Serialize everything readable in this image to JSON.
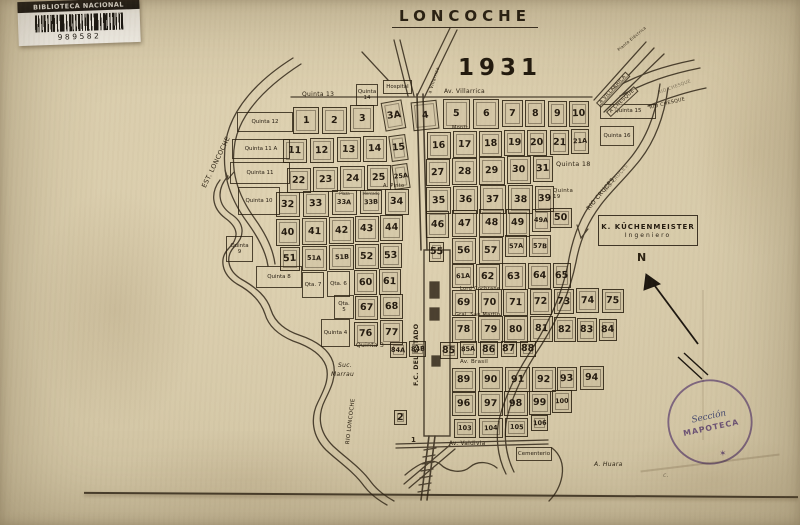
{
  "title": "LONCOCHE",
  "year": "1931",
  "barcode": {
    "library": "BIBLIOTECA NACIONAL",
    "number": "989582"
  },
  "credit": {
    "name": "K. KÜCHENMEISTER",
    "role": "Ingeniero"
  },
  "stamp": {
    "ring": "BIBLIOTECA NACIONAL",
    "star": "✶",
    "script": "Sección",
    "unit": "MAPOTECA"
  },
  "map": {
    "ink": "#2a2114",
    "blocks": [
      {
        "t": "1",
        "x": 293,
        "y": 107,
        "w": 26,
        "h": 27
      },
      {
        "t": "2",
        "x": 322,
        "y": 107,
        "w": 25,
        "h": 27
      },
      {
        "t": "3",
        "x": 350,
        "y": 105,
        "w": 24,
        "h": 27
      },
      {
        "t": "3A",
        "x": 383,
        "y": 101,
        "w": 21,
        "h": 29,
        "r": -10
      },
      {
        "t": "4",
        "x": 412,
        "y": 101,
        "w": 26,
        "h": 29,
        "r": -6
      },
      {
        "t": "5",
        "x": 443,
        "y": 99,
        "w": 27,
        "h": 30
      },
      {
        "t": "6",
        "x": 473,
        "y": 99,
        "w": 26,
        "h": 30
      },
      {
        "t": "7",
        "x": 502,
        "y": 100,
        "w": 21,
        "h": 27
      },
      {
        "t": "8",
        "x": 525,
        "y": 100,
        "w": 20,
        "h": 27
      },
      {
        "t": "9",
        "x": 548,
        "y": 101,
        "w": 19,
        "h": 26
      },
      {
        "t": "10",
        "x": 569,
        "y": 101,
        "w": 20,
        "h": 26
      },
      {
        "t": "11",
        "x": 283,
        "y": 139,
        "w": 24,
        "h": 24
      },
      {
        "t": "12",
        "x": 310,
        "y": 138,
        "w": 24,
        "h": 25
      },
      {
        "t": "13",
        "x": 337,
        "y": 137,
        "w": 24,
        "h": 25
      },
      {
        "t": "14",
        "x": 363,
        "y": 136,
        "w": 24,
        "h": 26
      },
      {
        "t": "15",
        "x": 390,
        "y": 135,
        "w": 17,
        "h": 26,
        "r": -8
      },
      {
        "t": "16",
        "x": 427,
        "y": 132,
        "w": 24,
        "h": 27
      },
      {
        "t": "17",
        "x": 453,
        "y": 131,
        "w": 24,
        "h": 27
      },
      {
        "t": "18",
        "x": 479,
        "y": 131,
        "w": 23,
        "h": 26
      },
      {
        "t": "19",
        "x": 504,
        "y": 130,
        "w": 21,
        "h": 26
      },
      {
        "t": "20",
        "x": 527,
        "y": 130,
        "w": 20,
        "h": 26
      },
      {
        "t": "21",
        "x": 550,
        "y": 130,
        "w": 19,
        "h": 25
      },
      {
        "t": "21A",
        "x": 571,
        "y": 129,
        "w": 18,
        "h": 25
      },
      {
        "t": "22",
        "x": 287,
        "y": 168,
        "w": 24,
        "h": 25
      },
      {
        "t": "23",
        "x": 313,
        "y": 167,
        "w": 25,
        "h": 25
      },
      {
        "t": "24",
        "x": 340,
        "y": 166,
        "w": 25,
        "h": 25
      },
      {
        "t": "25",
        "x": 367,
        "y": 165,
        "w": 24,
        "h": 25
      },
      {
        "t": "25A",
        "x": 393,
        "y": 164,
        "w": 16,
        "h": 25,
        "r": -8
      },
      {
        "t": "27",
        "x": 426,
        "y": 159,
        "w": 24,
        "h": 27
      },
      {
        "t": "28",
        "x": 452,
        "y": 158,
        "w": 25,
        "h": 27
      },
      {
        "t": "29",
        "x": 479,
        "y": 157,
        "w": 26,
        "h": 28
      },
      {
        "t": "30",
        "x": 507,
        "y": 156,
        "w": 24,
        "h": 28
      },
      {
        "t": "31",
        "x": 533,
        "y": 156,
        "w": 20,
        "h": 26
      },
      {
        "t": "32",
        "x": 276,
        "y": 192,
        "w": 24,
        "h": 25
      },
      {
        "t": "33",
        "x": 303,
        "y": 191,
        "w": 26,
        "h": 26
      },
      {
        "t": "33A",
        "x": 332,
        "y": 190,
        "w": 25,
        "h": 25,
        "c": "Plaza"
      },
      {
        "t": "33B",
        "x": 360,
        "y": 190,
        "w": 22,
        "h": 24,
        "c": "Mercado"
      },
      {
        "t": "34",
        "x": 385,
        "y": 189,
        "w": 24,
        "h": 26
      },
      {
        "t": "35",
        "x": 426,
        "y": 187,
        "w": 25,
        "h": 27
      },
      {
        "t": "36",
        "x": 453,
        "y": 186,
        "w": 25,
        "h": 28
      },
      {
        "t": "37",
        "x": 480,
        "y": 185,
        "w": 26,
        "h": 29
      },
      {
        "t": "38",
        "x": 508,
        "y": 185,
        "w": 25,
        "h": 29
      },
      {
        "t": "39",
        "x": 535,
        "y": 186,
        "w": 19,
        "h": 26
      },
      {
        "t": "50",
        "x": 550,
        "y": 208,
        "w": 22,
        "h": 20
      },
      {
        "t": "40",
        "x": 276,
        "y": 219,
        "w": 24,
        "h": 27
      },
      {
        "t": "41",
        "x": 302,
        "y": 218,
        "w": 25,
        "h": 27
      },
      {
        "t": "42",
        "x": 329,
        "y": 217,
        "w": 25,
        "h": 27
      },
      {
        "t": "43",
        "x": 355,
        "y": 216,
        "w": 24,
        "h": 26
      },
      {
        "t": "44",
        "x": 380,
        "y": 215,
        "w": 23,
        "h": 26
      },
      {
        "t": "46",
        "x": 426,
        "y": 211,
        "w": 23,
        "h": 27
      },
      {
        "t": "47",
        "x": 452,
        "y": 210,
        "w": 25,
        "h": 27
      },
      {
        "t": "48",
        "x": 479,
        "y": 209,
        "w": 25,
        "h": 28
      },
      {
        "t": "49",
        "x": 506,
        "y": 209,
        "w": 24,
        "h": 28
      },
      {
        "t": "49A",
        "x": 532,
        "y": 209,
        "w": 19,
        "h": 23
      },
      {
        "t": "51",
        "x": 280,
        "y": 247,
        "w": 20,
        "h": 24
      },
      {
        "t": "51A",
        "x": 302,
        "y": 246,
        "w": 25,
        "h": 25
      },
      {
        "t": "51B",
        "x": 329,
        "y": 245,
        "w": 25,
        "h": 25
      },
      {
        "t": "52",
        "x": 355,
        "y": 244,
        "w": 24,
        "h": 25
      },
      {
        "t": "53",
        "x": 380,
        "y": 243,
        "w": 22,
        "h": 25
      },
      {
        "t": "55",
        "x": 429,
        "y": 242,
        "w": 15,
        "h": 20
      },
      {
        "t": "56",
        "x": 452,
        "y": 238,
        "w": 24,
        "h": 26
      },
      {
        "t": "57",
        "x": 479,
        "y": 237,
        "w": 24,
        "h": 27
      },
      {
        "t": "57A",
        "x": 505,
        "y": 235,
        "w": 22,
        "h": 22
      },
      {
        "t": "57B",
        "x": 529,
        "y": 235,
        "w": 22,
        "h": 22
      },
      {
        "t": "60",
        "x": 354,
        "y": 270,
        "w": 23,
        "h": 25
      },
      {
        "t": "61",
        "x": 379,
        "y": 269,
        "w": 22,
        "h": 26
      },
      {
        "t": "61A",
        "x": 452,
        "y": 264,
        "w": 22,
        "h": 24
      },
      {
        "t": "62",
        "x": 476,
        "y": 264,
        "w": 24,
        "h": 26
      },
      {
        "t": "63",
        "x": 502,
        "y": 263,
        "w": 24,
        "h": 27
      },
      {
        "t": "64",
        "x": 528,
        "y": 263,
        "w": 23,
        "h": 26
      },
      {
        "t": "65",
        "x": 553,
        "y": 263,
        "w": 18,
        "h": 25
      },
      {
        "t": "67",
        "x": 355,
        "y": 296,
        "w": 23,
        "h": 24
      },
      {
        "t": "68",
        "x": 380,
        "y": 294,
        "w": 23,
        "h": 25
      },
      {
        "t": "69",
        "x": 452,
        "y": 290,
        "w": 24,
        "h": 26
      },
      {
        "t": "70",
        "x": 478,
        "y": 289,
        "w": 24,
        "h": 27
      },
      {
        "t": "71",
        "x": 503,
        "y": 289,
        "w": 25,
        "h": 27
      },
      {
        "t": "72",
        "x": 530,
        "y": 289,
        "w": 22,
        "h": 26
      },
      {
        "t": "73",
        "x": 554,
        "y": 289,
        "w": 20,
        "h": 25
      },
      {
        "t": "74",
        "x": 576,
        "y": 288,
        "w": 23,
        "h": 25
      },
      {
        "t": "75",
        "x": 602,
        "y": 289,
        "w": 22,
        "h": 24
      },
      {
        "t": "76",
        "x": 354,
        "y": 322,
        "w": 24,
        "h": 24
      },
      {
        "t": "77",
        "x": 380,
        "y": 320,
        "w": 23,
        "h": 25
      },
      {
        "t": "78",
        "x": 452,
        "y": 317,
        "w": 24,
        "h": 26
      },
      {
        "t": "79",
        "x": 478,
        "y": 316,
        "w": 25,
        "h": 27
      },
      {
        "t": "80",
        "x": 504,
        "y": 316,
        "w": 24,
        "h": 27
      },
      {
        "t": "81",
        "x": 530,
        "y": 316,
        "w": 23,
        "h": 26
      },
      {
        "t": "82",
        "x": 554,
        "y": 317,
        "w": 22,
        "h": 25
      },
      {
        "t": "83",
        "x": 577,
        "y": 318,
        "w": 20,
        "h": 24
      },
      {
        "t": "84",
        "x": 599,
        "y": 319,
        "w": 18,
        "h": 22
      },
      {
        "t": "84A",
        "x": 390,
        "y": 342,
        "w": 17,
        "h": 16
      },
      {
        "t": "84B",
        "x": 409,
        "y": 341,
        "w": 17,
        "h": 16
      },
      {
        "t": "85",
        "x": 440,
        "y": 342,
        "w": 18,
        "h": 17
      },
      {
        "t": "85A",
        "x": 460,
        "y": 341,
        "w": 17,
        "h": 17
      },
      {
        "t": "86",
        "x": 480,
        "y": 341,
        "w": 18,
        "h": 17
      },
      {
        "t": "87",
        "x": 501,
        "y": 341,
        "w": 16,
        "h": 16
      },
      {
        "t": "88",
        "x": 520,
        "y": 341,
        "w": 16,
        "h": 16
      },
      {
        "t": "89",
        "x": 452,
        "y": 368,
        "w": 24,
        "h": 24
      },
      {
        "t": "90",
        "x": 479,
        "y": 367,
        "w": 24,
        "h": 25
      },
      {
        "t": "91",
        "x": 505,
        "y": 367,
        "w": 25,
        "h": 25
      },
      {
        "t": "92",
        "x": 532,
        "y": 367,
        "w": 24,
        "h": 25
      },
      {
        "t": "93",
        "x": 557,
        "y": 367,
        "w": 20,
        "h": 24
      },
      {
        "t": "94",
        "x": 580,
        "y": 366,
        "w": 24,
        "h": 24
      },
      {
        "t": "96",
        "x": 452,
        "y": 392,
        "w": 24,
        "h": 24
      },
      {
        "t": "97",
        "x": 478,
        "y": 391,
        "w": 25,
        "h": 25
      },
      {
        "t": "98",
        "x": 504,
        "y": 391,
        "w": 24,
        "h": 25
      },
      {
        "t": "99",
        "x": 529,
        "y": 391,
        "w": 22,
        "h": 24
      },
      {
        "t": "100",
        "x": 552,
        "y": 390,
        "w": 20,
        "h": 23
      },
      {
        "t": "103",
        "x": 454,
        "y": 419,
        "w": 22,
        "h": 19
      },
      {
        "t": "104",
        "x": 479,
        "y": 418,
        "w": 24,
        "h": 20
      },
      {
        "t": "105",
        "x": 505,
        "y": 418,
        "w": 23,
        "h": 19
      },
      {
        "t": "106",
        "x": 531,
        "y": 415,
        "w": 17,
        "h": 16
      },
      {
        "t": "2",
        "x": 394,
        "y": 410,
        "w": 13,
        "h": 15
      }
    ],
    "quintas": [
      {
        "t": "Quinta 12",
        "x": 237,
        "y": 112,
        "w": 56,
        "h": 20
      },
      {
        "t": "Quinta 11 A",
        "x": 232,
        "y": 139,
        "w": 58,
        "h": 20
      },
      {
        "t": "Quinta 11",
        "x": 230,
        "y": 162,
        "w": 60,
        "h": 22
      },
      {
        "t": "Quinta 10",
        "x": 238,
        "y": 187,
        "w": 42,
        "h": 28
      },
      {
        "t": "Quinta 9",
        "x": 226,
        "y": 236,
        "w": 27,
        "h": 26
      },
      {
        "t": "Quinta 8",
        "x": 256,
        "y": 266,
        "w": 46,
        "h": 22
      },
      {
        "t": "Qta. 7",
        "x": 302,
        "y": 272,
        "w": 22,
        "h": 26
      },
      {
        "t": "Qta. 6",
        "x": 327,
        "y": 271,
        "w": 23,
        "h": 26
      },
      {
        "t": "Qta. 5",
        "x": 334,
        "y": 295,
        "w": 20,
        "h": 24
      },
      {
        "t": "Quinta 4",
        "x": 321,
        "y": 319,
        "w": 29,
        "h": 28
      },
      {
        "t": "Quinta 14",
        "x": 356,
        "y": 84,
        "w": 22,
        "h": 22
      },
      {
        "t": "Hospital",
        "x": 383,
        "y": 80,
        "w": 29,
        "h": 14
      },
      {
        "t": "Quinta 15",
        "x": 600,
        "y": 104,
        "w": 56,
        "h": 15
      },
      {
        "t": "Quinta 16",
        "x": 600,
        "y": 126,
        "w": 34,
        "h": 20
      },
      {
        "t": "Cementerio",
        "x": 516,
        "y": 447,
        "w": 36,
        "h": 14
      }
    ],
    "labels": [
      {
        "t": "Quinta 13",
        "x": 302,
        "y": 92,
        "s": 6
      },
      {
        "t": "Quinta 18",
        "x": 556,
        "y": 161,
        "s": 6.5
      },
      {
        "t": "Quinta 19",
        "x": 553,
        "y": 189,
        "s": 5.5,
        "w": 26
      },
      {
        "t": "Quinta 3",
        "x": 356,
        "y": 343,
        "s": 6
      },
      {
        "t": "Suc.",
        "x": 338,
        "y": 363,
        "s": 6,
        "i": 1
      },
      {
        "t": "Marrau",
        "x": 331,
        "y": 372,
        "s": 6,
        "i": 1
      },
      {
        "t": "A. Huara",
        "x": 594,
        "y": 462,
        "s": 6,
        "i": 1
      },
      {
        "t": "c.",
        "x": 663,
        "y": 473,
        "s": 6,
        "i": 1,
        "cls": "faint"
      },
      {
        "t": "N",
        "x": 637,
        "y": 252,
        "s": 11,
        "b": 1
      },
      {
        "t": "1",
        "x": 411,
        "y": 437,
        "s": 7,
        "b": 1
      },
      {
        "t": "Av. Villarrica",
        "x": 444,
        "y": 89,
        "s": 6
      },
      {
        "t": "Montt",
        "x": 452,
        "y": 126,
        "s": 5
      },
      {
        "t": "A. Pinto",
        "x": 383,
        "y": 184,
        "s": 5
      },
      {
        "t": "Lord Cochrane",
        "x": 460,
        "y": 287,
        "s": 5
      },
      {
        "t": "Gral. San Martin",
        "x": 455,
        "y": 313,
        "s": 5
      },
      {
        "t": "Av. Brasil",
        "x": 460,
        "y": 360,
        "s": 5.5
      },
      {
        "t": "Av. Valdivia",
        "x": 449,
        "y": 441,
        "s": 5.8
      },
      {
        "t": "F.C. DEL ESTADO",
        "x": 414,
        "y": 386,
        "s": 6.2,
        "r": -90,
        "b": 1
      },
      {
        "t": "RIO LONCOCHE",
        "x": 346,
        "y": 444,
        "s": 5.5,
        "r": -83
      },
      {
        "t": "EST. LONCOCHE",
        "x": 201,
        "y": 186,
        "s": 6.5,
        "r": -64
      },
      {
        "t": "RIO CRUCES",
        "x": 586,
        "y": 208,
        "s": 6,
        "r": -50
      },
      {
        "t": "RIO CRUCES",
        "x": 604,
        "y": 190,
        "s": 5,
        "r": -50,
        "cls": "faint"
      },
      {
        "t": "RIO CHESQUE",
        "x": 649,
        "y": 106,
        "s": 4.8,
        "r": -14
      },
      {
        "t": "RIO CHESQUE",
        "x": 658,
        "y": 92,
        "s": 4.5,
        "r": -20,
        "cls": "faint"
      },
      {
        "t": "A CHESQUE",
        "x": 606,
        "y": 112,
        "s": 5,
        "r": -43,
        "cls": "box"
      },
      {
        "t": "A VILLARRICA",
        "x": 596,
        "y": 103,
        "s": 4.8,
        "r": -47,
        "cls": "box"
      },
      {
        "t": "Planta Eléctrica",
        "x": 617,
        "y": 49,
        "s": 4,
        "r": -40
      },
      {
        "t": "a Villarrica",
        "x": 429,
        "y": 93,
        "s": 4.5,
        "r": -72
      }
    ]
  }
}
